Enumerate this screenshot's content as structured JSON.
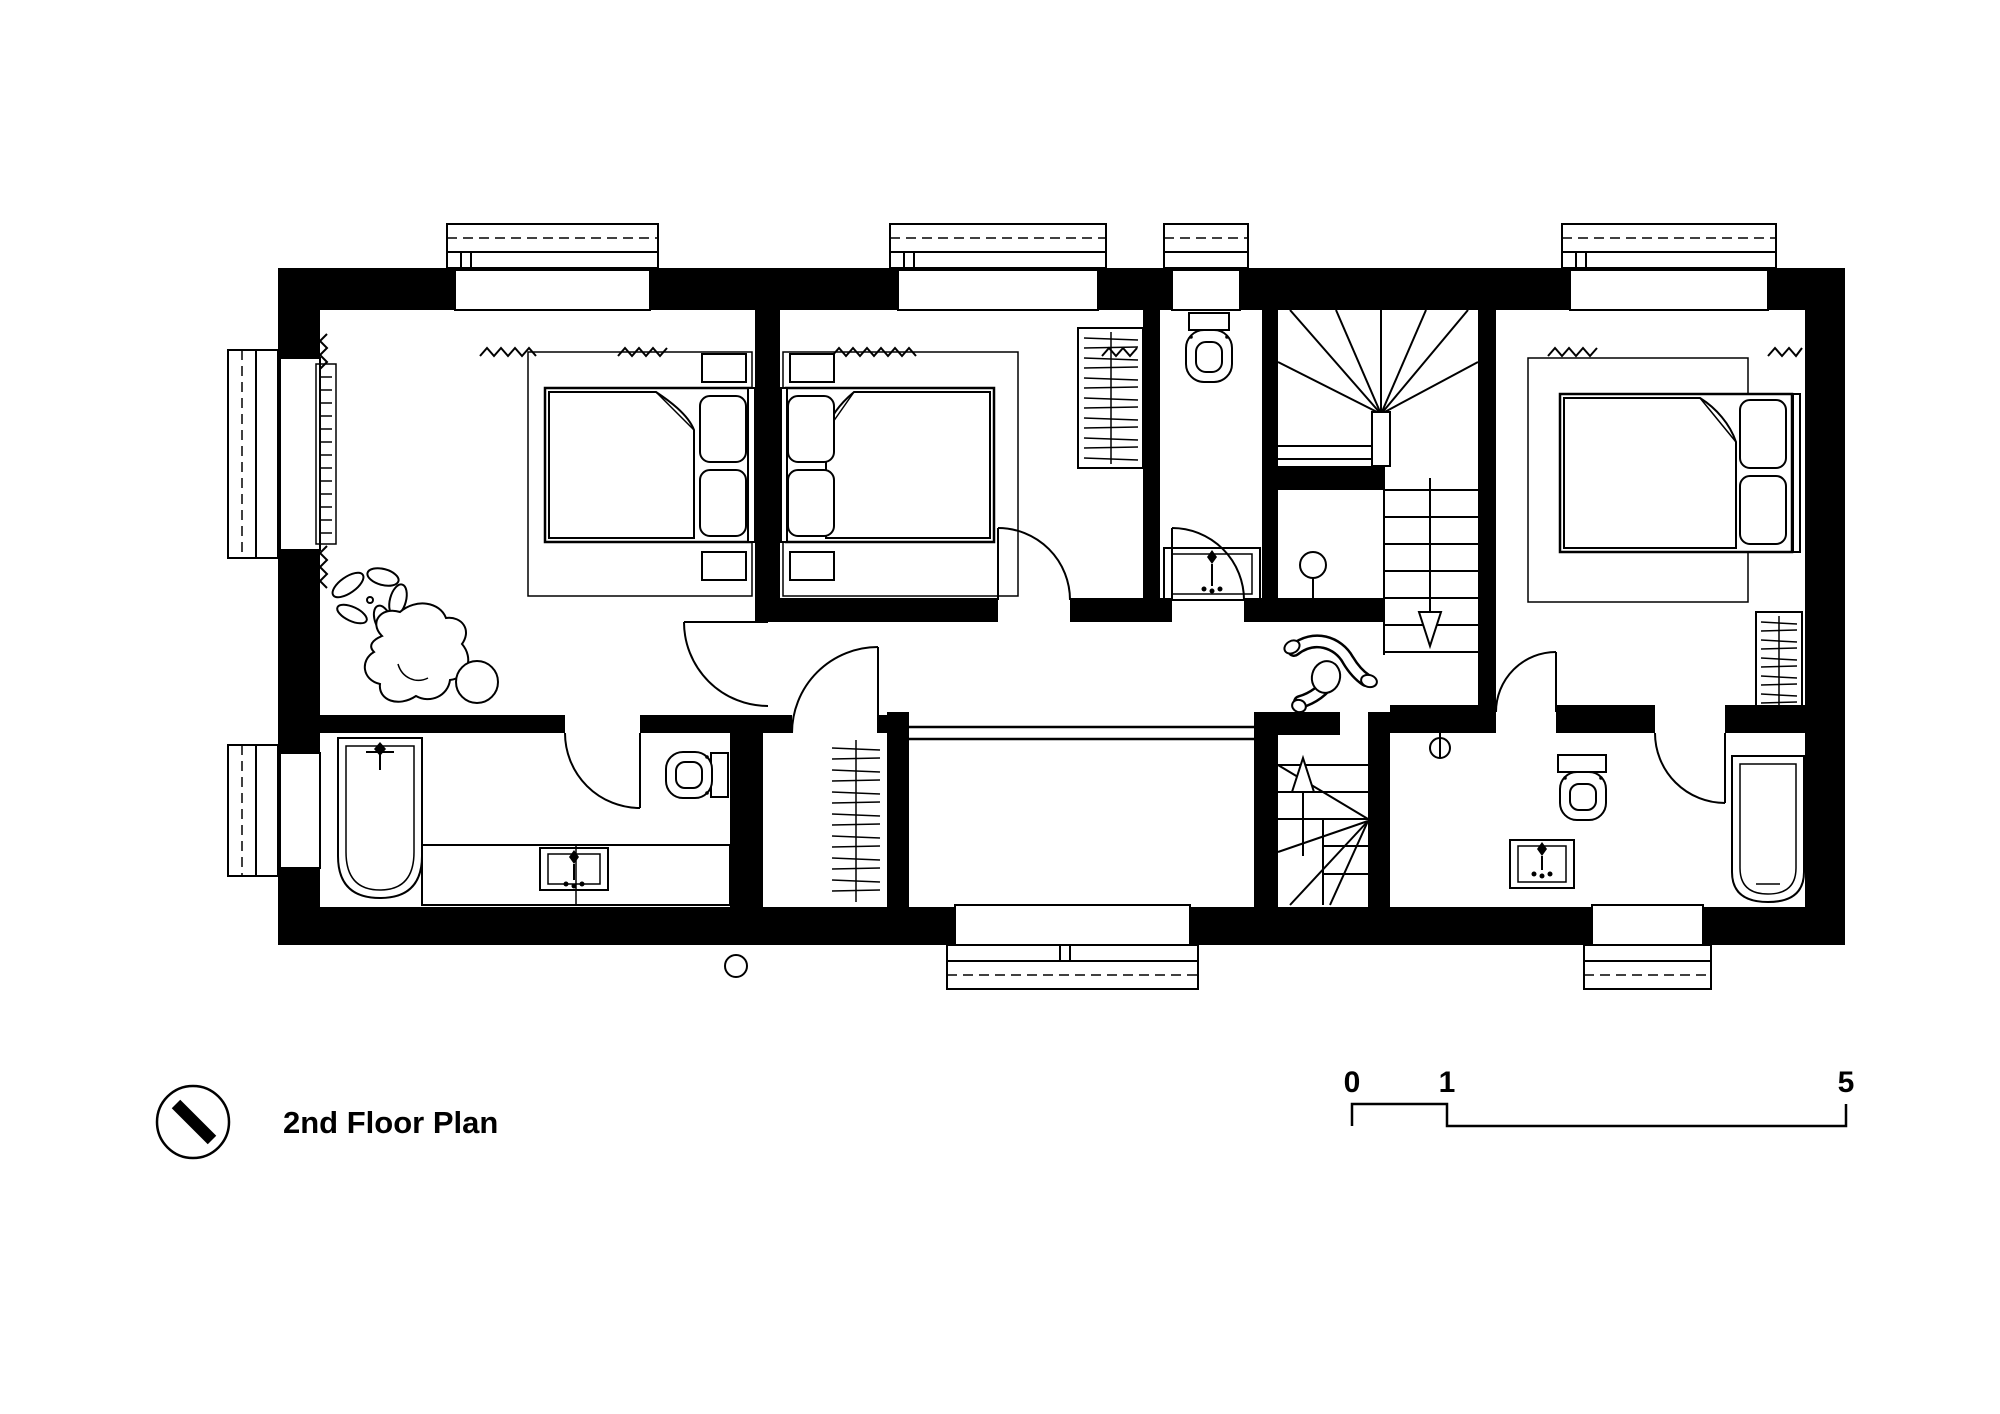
{
  "title_block": {
    "label": "2nd Floor Plan"
  },
  "scale_bar": {
    "zero": "0",
    "one": "1",
    "five": "5"
  },
  "palette": {
    "ink": "#000000",
    "paper": "#ffffff"
  },
  "drawing": {
    "type": "architectural-floor-plan",
    "floor": "2nd",
    "icons": [
      "north-arrow-icon",
      "window-icon",
      "door-swing-icon",
      "double-bed-icon",
      "pillow-icon",
      "rug-icon",
      "wardrobe-rail-icon",
      "radiator-icon",
      "plant-icon",
      "armchair-icon",
      "ottoman-icon",
      "toilet-icon",
      "sink-icon",
      "vanity-icon",
      "bathtub-icon",
      "winder-stair-icon",
      "straight-stair-icon",
      "stair-direction-arrow-icon",
      "railing-icon",
      "person-icon",
      "curtain-icon"
    ]
  }
}
